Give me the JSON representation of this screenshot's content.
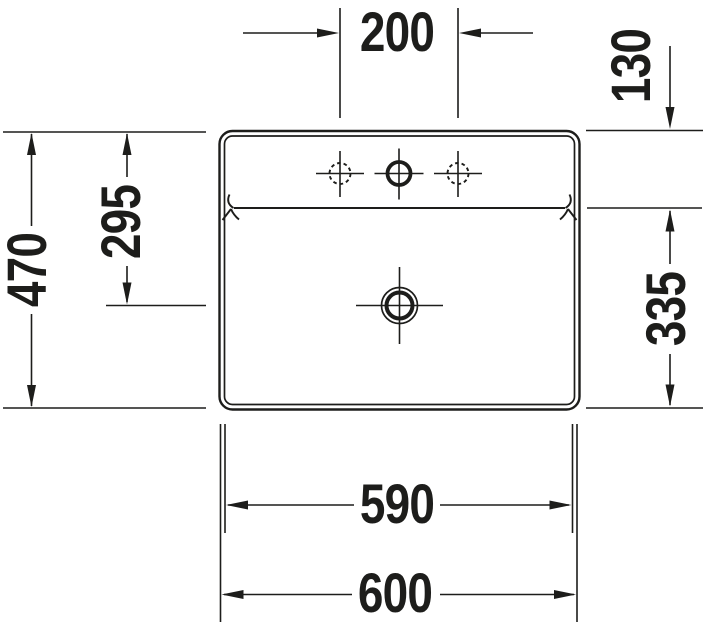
{
  "colors": {
    "line": "#1d1d1b",
    "background": "#ffffff"
  },
  "labels": {
    "tap_hole_spacing": "200",
    "rim_to_bowl_edge": "130",
    "overall_depth": "470",
    "rim_to_drain_center": "295",
    "bowl_edge_to_front": "335",
    "lower_width": "590",
    "overall_width": "600"
  }
}
